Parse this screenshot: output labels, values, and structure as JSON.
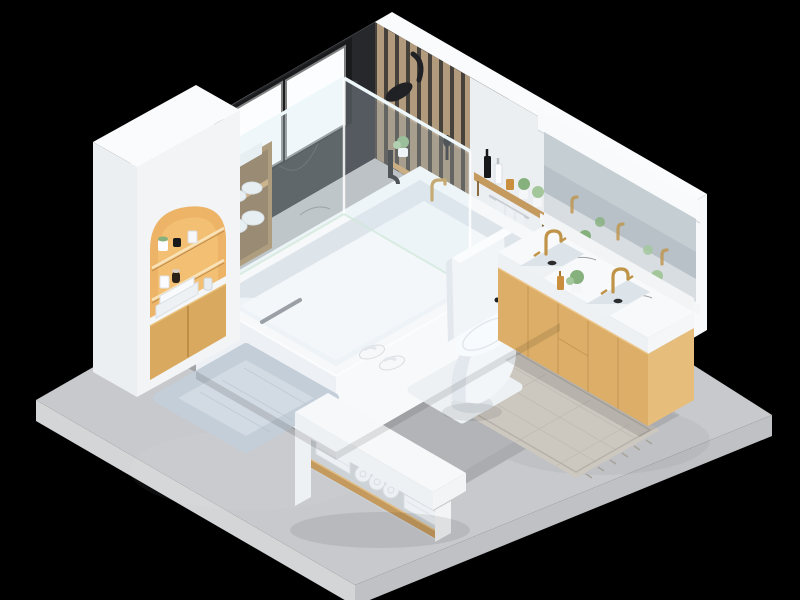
{
  "scene": {
    "title": "Isometric 3D render of a modern bathroom interior",
    "style": "isometric cutaway room on a concrete platform, black background"
  },
  "palette": {
    "background": "#000000",
    "base_concrete": "#c7c9cc",
    "base_side_left": "#d3d5d7",
    "base_side_right": "#bfc1c4",
    "floor_concrete": "#b2b4b7",
    "floor_side": "#a2a4a8",
    "wall_white": "#f2f4f6",
    "wall_white_shade": "#eceff2",
    "wall_top": "#fafbfc",
    "marble_black": "#26282c",
    "window_frame": "#1a1b1d",
    "window_glass": "#fbfdfe",
    "slat_gap": "#46413a",
    "slat_wood": "#b29a7c",
    "glass_tint": "#d9ecf2",
    "glass_edge": "#eef8fb",
    "tub_white": "#f6f8fa",
    "tub_face": "#edf1f5",
    "basin_shade": "#dde4ea",
    "arch_wood": "#edb366",
    "arch_glow": "#f7c87c",
    "cabinet_wood": "#d8a95f",
    "vanity_wood": "#dcae67",
    "vanity_wood_light": "#e6bd7b",
    "shelf_wood": "#c59a5f",
    "counter_white": "#f7f9fb",
    "gold": "#bf9448",
    "toilet_white": "#f3f6f9",
    "mirror_glass": "#b7c1c7",
    "mirror_sheen": "#c9d2d7",
    "towel_white": "#eef1f4",
    "rug_beige": "#ccc8c0",
    "rug_line": "#b7b2a9",
    "mat_blue": "#c4ced9",
    "plant_green": "#86b07c",
    "plant_green_light": "#a3c79a",
    "fixture_black": "#1f2124"
  },
  "objects": {
    "platform": "concrete display platform",
    "floor": "polished concrete bathroom floor",
    "left_wall": "white wall with arched storage niche and wood cabinet",
    "back_left_wall": "black marble wall with sliding window",
    "slat_wall": "vertical wood slat shower wall with black shower head",
    "back_right_wall": "white wall with wood shelf, towel bars and toilet",
    "mirror": "marble framed vanity mirror",
    "vanity": "floating oak double vanity with marble top and gold faucets",
    "bathtub": "built-in white bathtub with glass shower screen",
    "toilet": "white one-piece toilet with U-shaped mat",
    "bench": "white towel console with oak shelf and rolled towels",
    "rug": "large woven beige area rug",
    "mat": "blue textured bath mat",
    "slippers": "pair of white slippers",
    "plants": "small potted succulents",
    "amenities": "soap bottles, jars and candles on shelves"
  }
}
